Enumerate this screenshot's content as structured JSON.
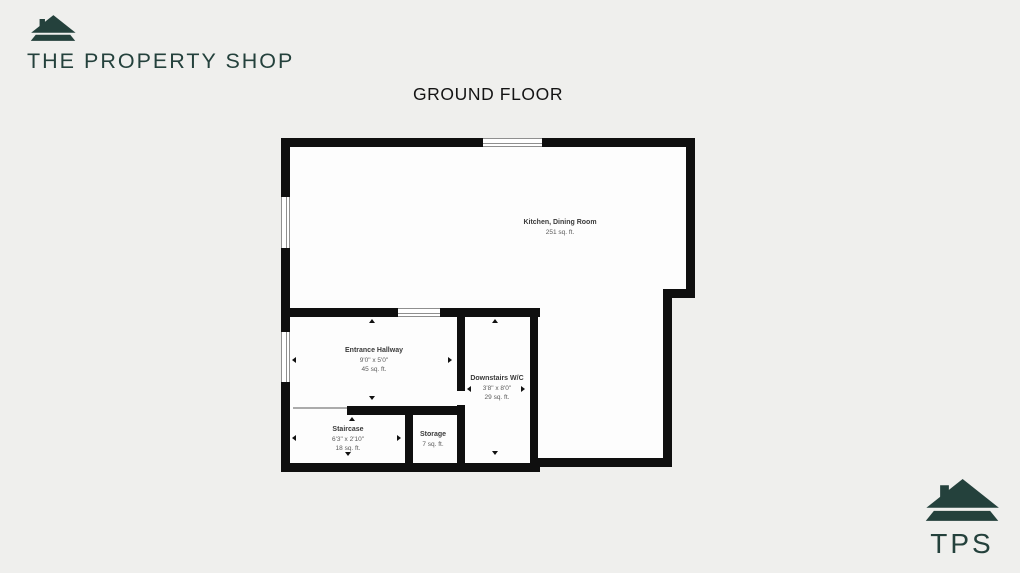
{
  "colors": {
    "brand": "#24413c",
    "background": "#efefed",
    "wall": "#0f0f0f",
    "room_fill": "#fdfdfd",
    "title_text": "#141414",
    "label_name": "#3a3a3a",
    "label_sub": "#5a5a5a",
    "window_line": "#8f8f8f"
  },
  "header": {
    "logo_text": "THE PROPERTY SHOP",
    "logo_icon": "house-icon"
  },
  "title": "GROUND FLOOR",
  "floorplan": {
    "rooms": [
      {
        "id": "kitchen-dining",
        "name": "Kitchen, Dining Room",
        "dimensions": "",
        "area": "251 sq. ft."
      },
      {
        "id": "entrance-hallway",
        "name": "Entrance Hallway",
        "dimensions": "9'0\" x 5'0\"",
        "area": "45 sq. ft."
      },
      {
        "id": "downstairs-wc",
        "name": "Downstairs W/C",
        "dimensions": "3'8\" x 8'0\"",
        "area": "29 sq. ft."
      },
      {
        "id": "staircase",
        "name": "Staircase",
        "dimensions": "6'3\" x 2'10\"",
        "area": "18 sq. ft."
      },
      {
        "id": "storage",
        "name": "Storage",
        "dimensions": "",
        "area": "7 sq. ft."
      }
    ]
  },
  "footer": {
    "logo_text": "TPS",
    "logo_icon": "house-icon"
  }
}
